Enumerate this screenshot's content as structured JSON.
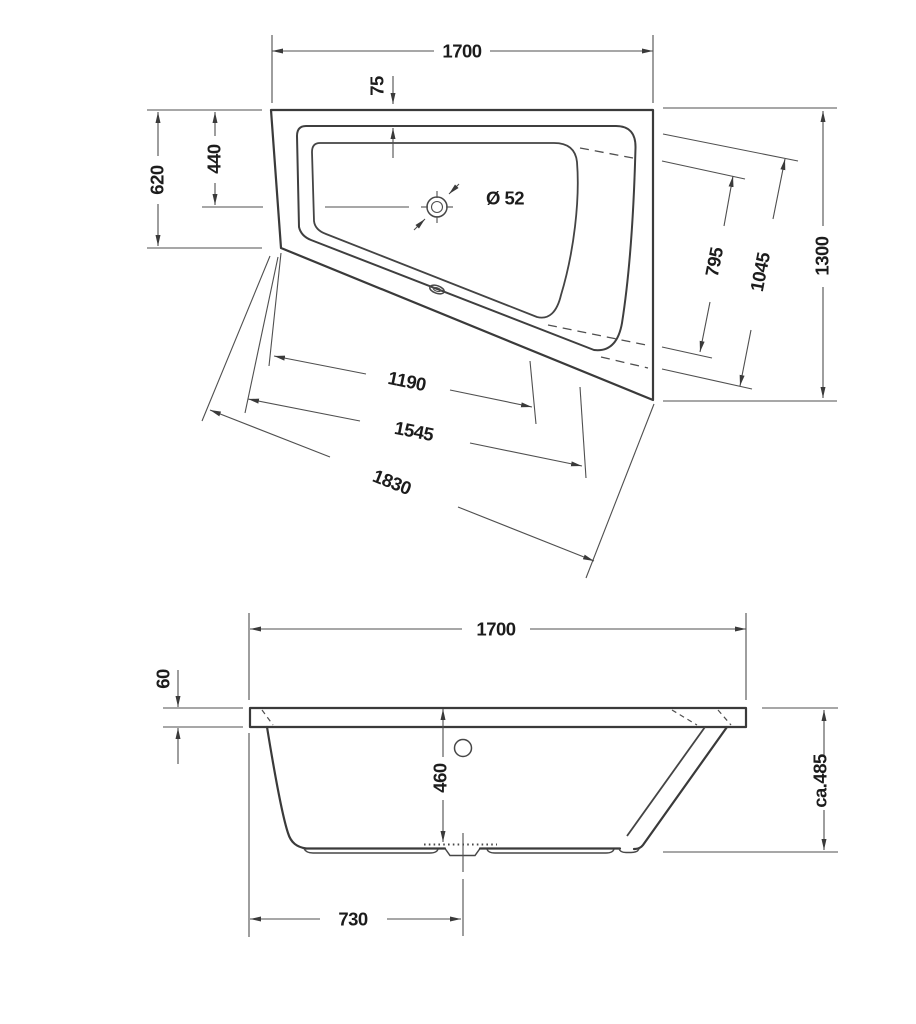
{
  "drawing": {
    "kind": "bathtub technical dimension drawing, two views",
    "colors": {
      "background": "#ffffff",
      "outline": "#3a3a3a",
      "dimension_lines": "#4f4f4f",
      "text": "#1c1c1c"
    },
    "symbols": {
      "drain": "crosshair-circle",
      "overflow": "small-oval"
    },
    "top_view": {
      "width": "1700",
      "rim_offset": "75",
      "left_side_total": "620",
      "drain_from_back": "440",
      "drain_diameter": "Ø 52",
      "right_side_total": "1300",
      "seat_edge_inner": "795",
      "seat_edge_outer": "1045",
      "bottom_edge_inner": "1190",
      "bottom_edge_outer": "1545",
      "wall_length": "1830"
    },
    "side_view": {
      "width": "1700",
      "rim_thickness": "60",
      "inner_depth": "460",
      "total_height": "ca.485",
      "drain_from_left": "730"
    }
  }
}
